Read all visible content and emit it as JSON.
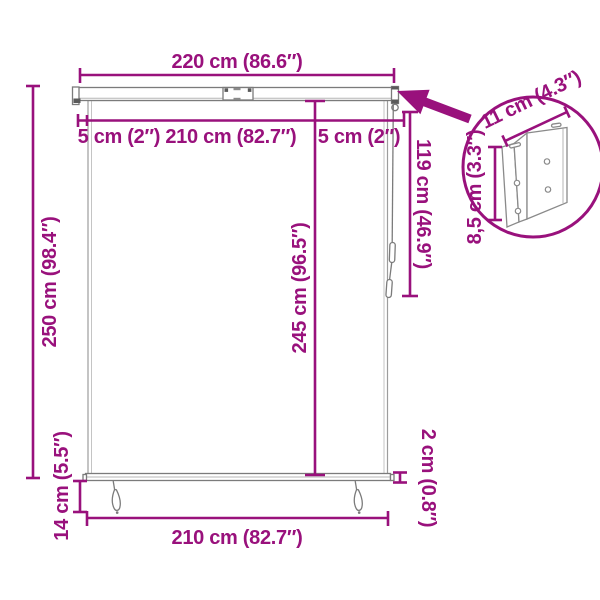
{
  "colors": {
    "dimension_accent": "#99117C",
    "structure_line": "#7b7b7b",
    "background": "#ffffff"
  },
  "diagram": {
    "type": "product-dimension-diagram",
    "subject": "vertical roller blind with top cassette, pull cords and wall-bracket detail inset",
    "labels": {
      "total_width": "220 cm (86.6″)",
      "top_margins_and_fabric_width": "5 cm (2″) 210 cm (82.7″)",
      "top_right_margin": "5 cm (2″)",
      "right_drop": "119 cm (46.9″)",
      "center_drop": "245 cm (96.5″)",
      "total_height": "250 cm (98.4″)",
      "bottom_clearance": "14 cm (5.5″)",
      "bottom_width": "210 cm (82.7″)",
      "bottom_bar_thickness": "2 cm (0.8″)",
      "bracket_width": "11 cm (4.3″)",
      "bracket_height": "8,5 cm (3.3″)"
    }
  }
}
